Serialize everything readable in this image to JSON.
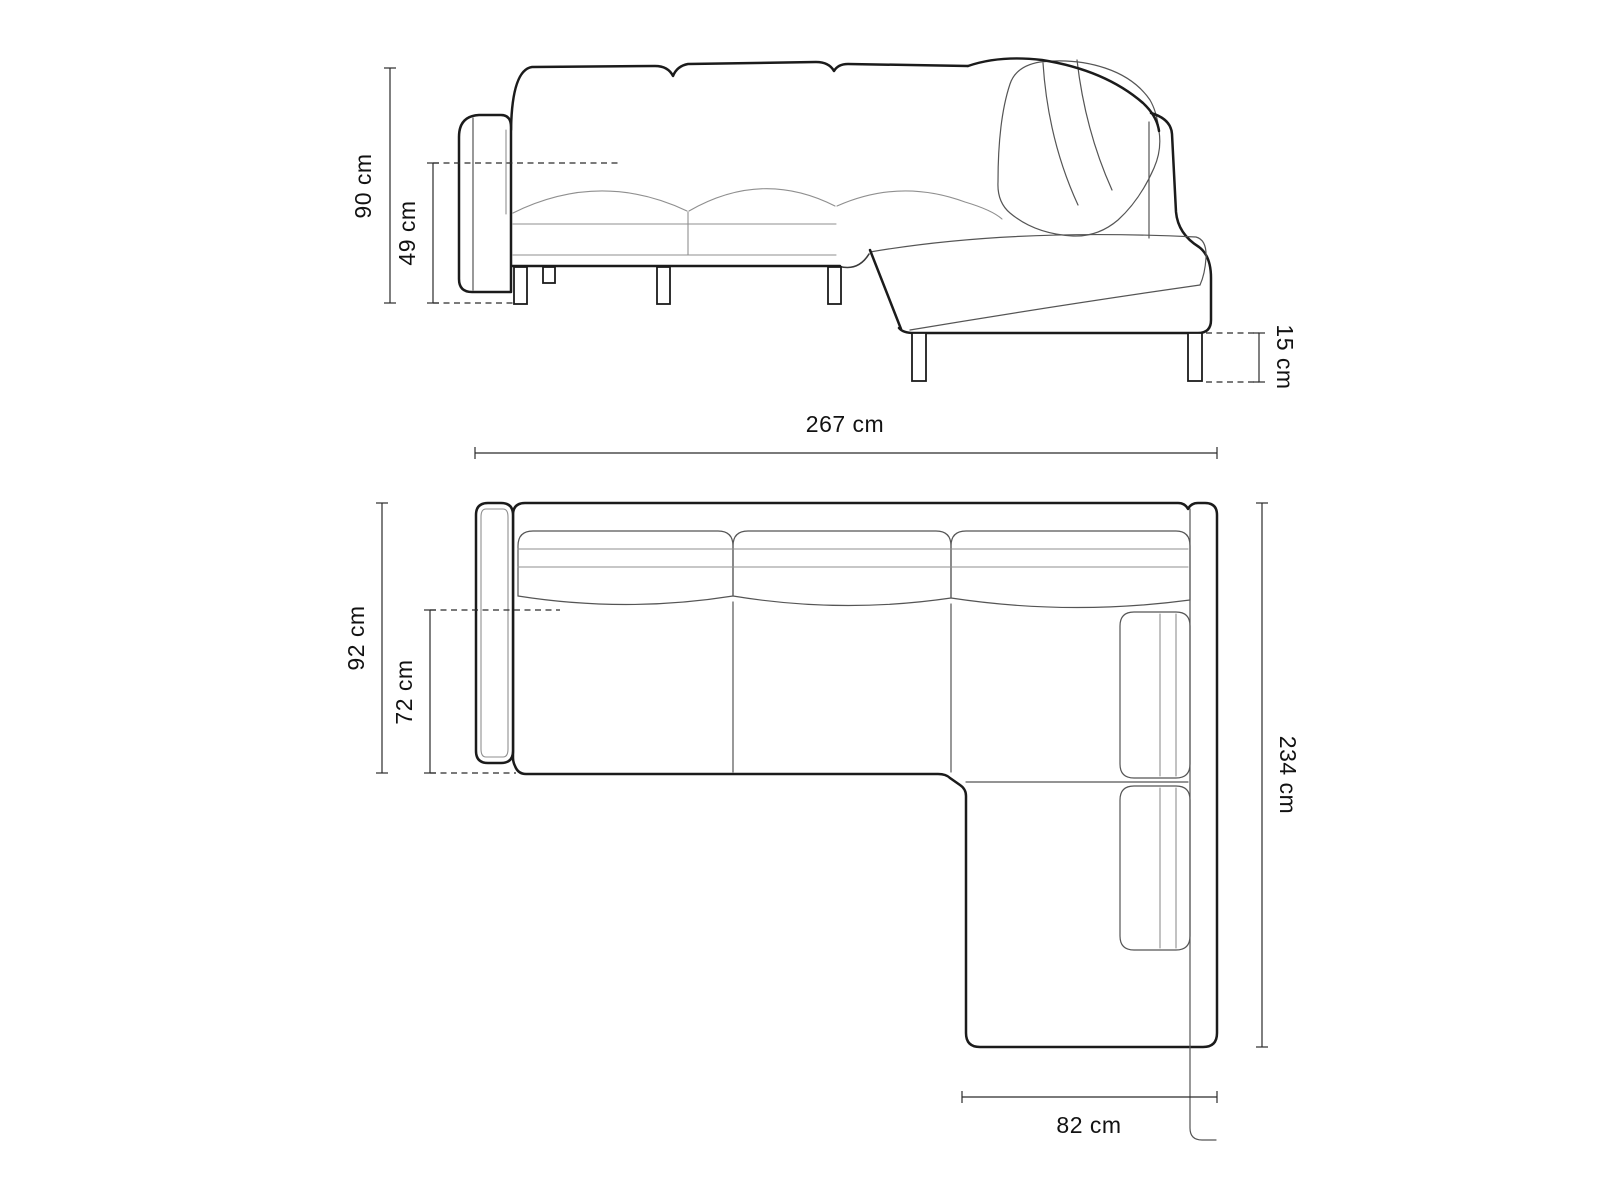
{
  "diagram": {
    "type": "furniture-dimension-drawing",
    "subject": "corner sectional sofa with chaise longue, front elevation and top plan views",
    "unit": "cm",
    "views": [
      {
        "name": "front-elevation",
        "dimensions": [
          {
            "id": "total-height",
            "label": "90 cm",
            "value": 90,
            "orientation": "vertical-left"
          },
          {
            "id": "seat-height",
            "label": "49 cm",
            "value": 49,
            "orientation": "vertical-left"
          },
          {
            "id": "leg-height",
            "label": "15 cm",
            "value": 15,
            "orientation": "vertical-right"
          }
        ]
      },
      {
        "name": "top-plan",
        "dimensions": [
          {
            "id": "total-width",
            "label": "267 cm",
            "value": 267,
            "orientation": "horizontal-top"
          },
          {
            "id": "total-depth",
            "label": "92 cm",
            "value": 92,
            "orientation": "vertical-left"
          },
          {
            "id": "seat-depth",
            "label": "72 cm",
            "value": 72,
            "orientation": "vertical-left"
          },
          {
            "id": "total-length",
            "label": "234 cm",
            "value": 234,
            "orientation": "vertical-right"
          },
          {
            "id": "chaise-width",
            "label": "82 cm",
            "value": 82,
            "orientation": "horizontal-bottom"
          }
        ]
      }
    ],
    "colors": {
      "background": "#ffffff",
      "outline_strong": "#1b1b1b",
      "outline_light": "#8f8f8f",
      "dimension_lines": "#2b2b2b",
      "text": "#121212"
    }
  }
}
